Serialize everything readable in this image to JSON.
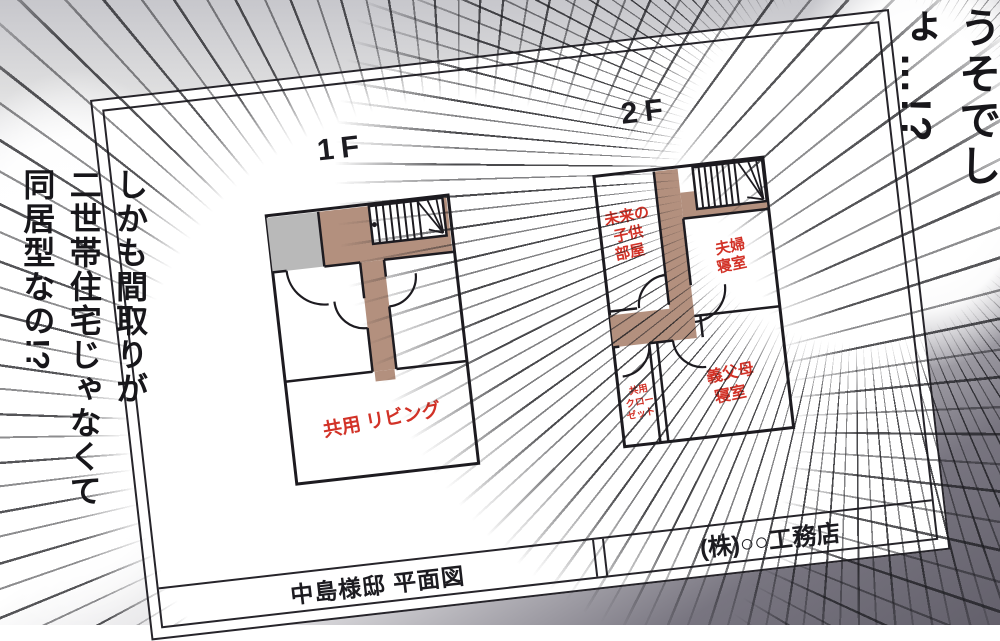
{
  "speech": {
    "right_exclamation": "うそでしょ…!?",
    "left_lines": [
      "しかも間取りが",
      "二世帯住宅じゃなくて",
      "同居型なの!?"
    ]
  },
  "floorplan": {
    "sheet_title": "中島様邸 平面図",
    "company": "(株)○○工務店",
    "floor1": {
      "label": "1F",
      "rooms": {
        "living": "共用 リビング"
      }
    },
    "floor2": {
      "label": "2F",
      "rooms": {
        "kids": [
          "未来の",
          "子供",
          "部屋"
        ],
        "couple": [
          "夫婦",
          "寝室"
        ],
        "closet": [
          "共用",
          "クロー",
          "ゼット"
        ],
        "inlaws": [
          "義父母",
          "寝室"
        ]
      }
    },
    "colors": {
      "corridor_brown": "#b3907e",
      "entrance_gray": "#b9b9b9",
      "room_label_red": "#d23227",
      "wall_black": "#1d1b20"
    }
  }
}
